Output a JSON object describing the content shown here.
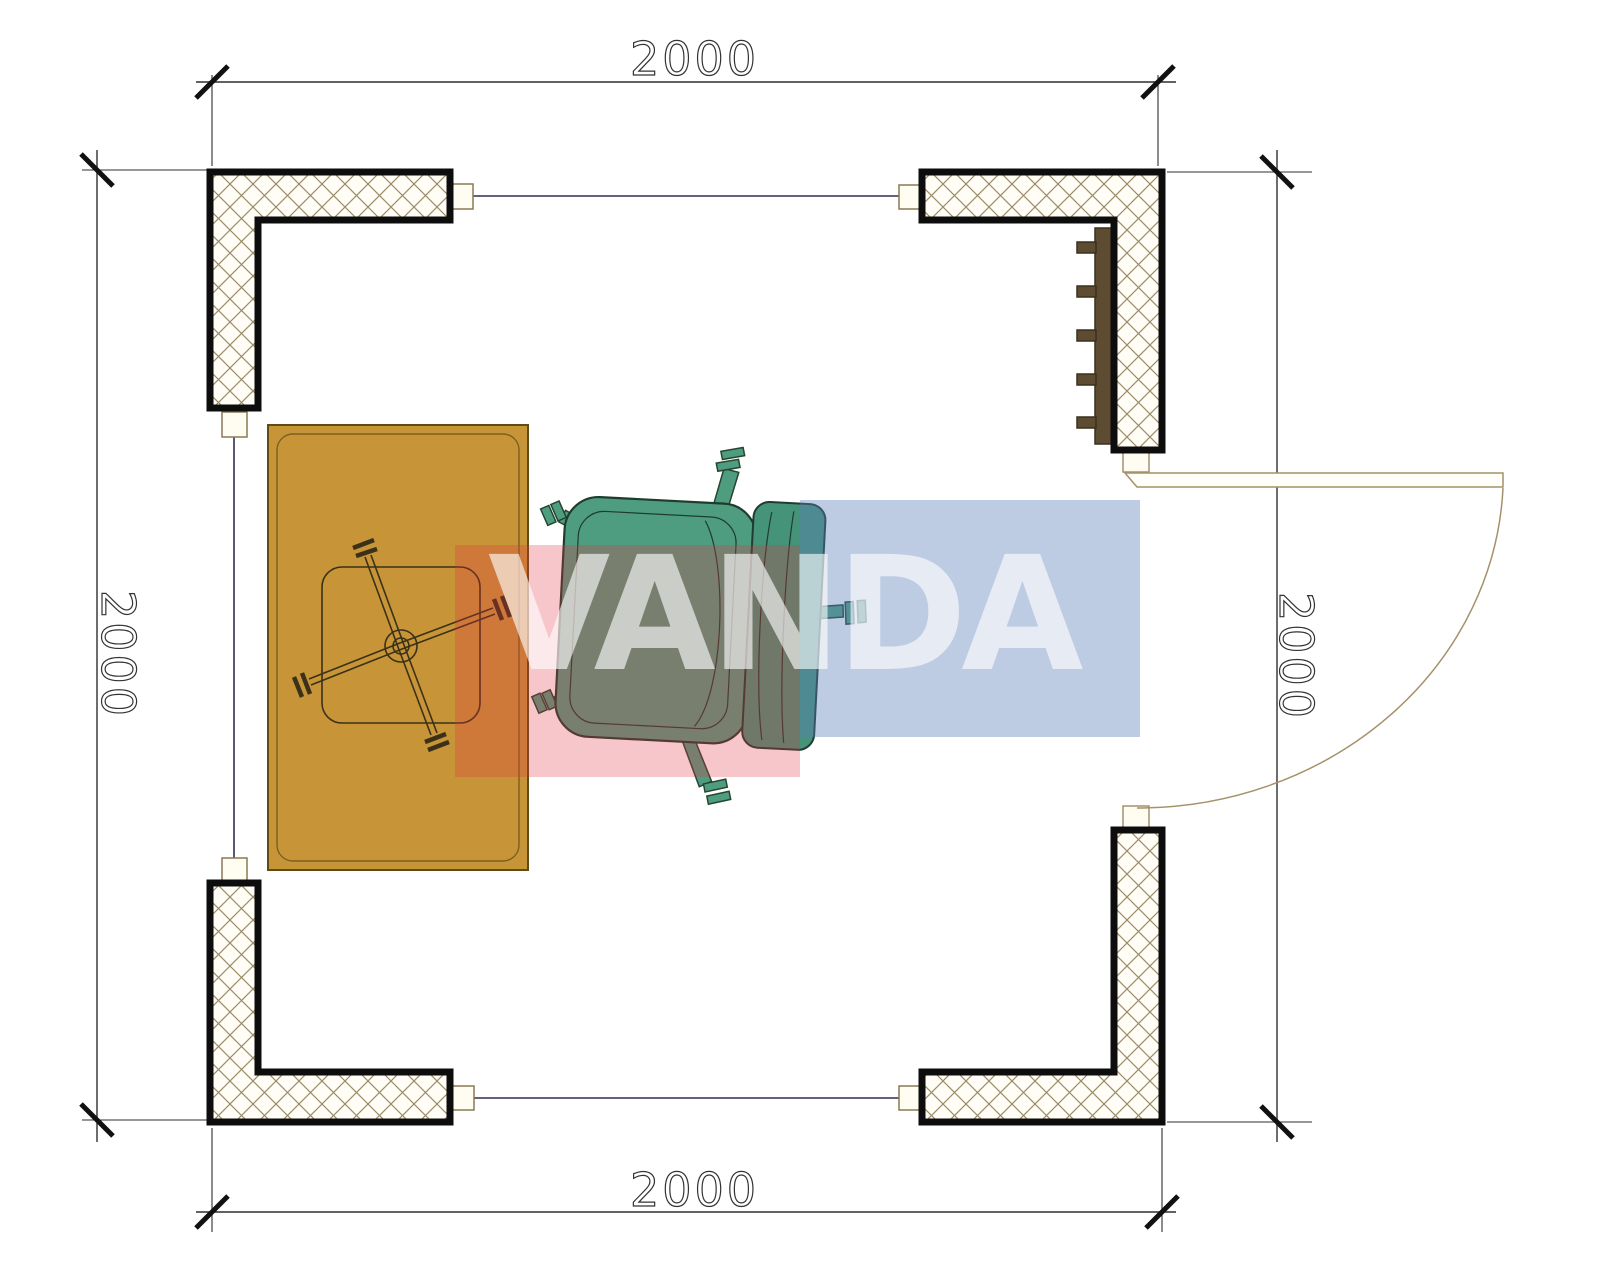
{
  "plan": {
    "title": "square room floor plan 2000 x 2000",
    "dimensions": {
      "top": {
        "label": "2000"
      },
      "bottom": {
        "label": "2000"
      },
      "left": {
        "label": "2000"
      },
      "right": {
        "label": "2000"
      }
    },
    "watermark": {
      "text": "VANDA",
      "red_block_color": "#e23342",
      "blue_block_color": "#5a7db9",
      "text_color": "#ffffff"
    },
    "colors": {
      "desk": "#c79537",
      "desk_inner_line": "#7a6120",
      "chair_seat": "#4f9d80",
      "chair_back": "#459379",
      "chair_outline": "#1f3d2f",
      "radiator": "#5d4c32",
      "wall_outline": "#0d0d0d",
      "wall_hatch": "#9b8c68",
      "connector_line": "#2e2e55",
      "door": "#a5916a",
      "dimension_line": "#2f2f2f"
    },
    "objects": {
      "walls": "four hatched corner wall segments",
      "door": "door leaf with quarter-circle swing arc, right side",
      "radiator": "wall radiator with five fins, top right interior",
      "desk": "rectangular desk with swivel chair base, left side",
      "office_chair": "teal office chair with five casters, center"
    }
  }
}
